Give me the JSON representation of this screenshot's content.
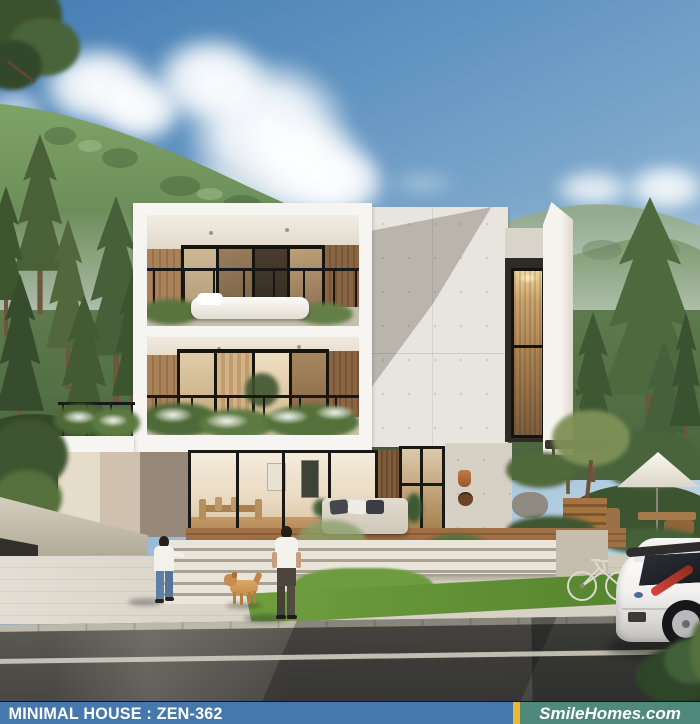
{
  "banner": {
    "model_label": "MINIMAL HOUSE : ZEN-362",
    "brand_label": "SmileHomes.com",
    "colors": {
      "left_bg": "#4579ae",
      "divider": "#f2b62f",
      "right_bg": "#4f897b",
      "text": "#ffffff"
    }
  },
  "scene": {
    "palette": {
      "sky_top": "#457db4",
      "sky_horizon": "#d9e7f0",
      "mountain_green": "#5f7e4e",
      "foliage_dark": "#3f5531",
      "house_white": "#f6f5f2",
      "warm_wood": "#a9825a",
      "concrete": "#e6e3dc",
      "deck_wood": "#9c6b42",
      "grass": "#6f9f3e",
      "road_asphalt": "#4f4e49",
      "car_white": "#f2f2f0",
      "taillight_red": "#b5372a",
      "dog_gold": "#c68d4e",
      "jeans_blue": "#5e80a4"
    }
  }
}
